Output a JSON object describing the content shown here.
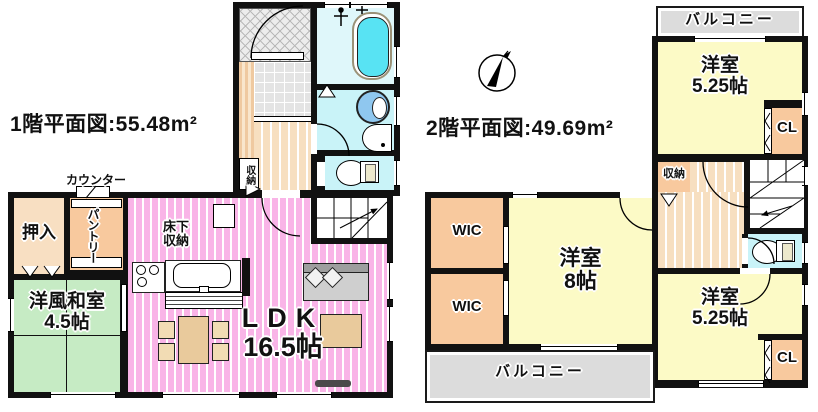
{
  "floor1": {
    "title": "1階平面図:55.48m²",
    "counter_label": "カウンター",
    "pantry": "パントリー",
    "oshiire": "押入",
    "underfloor": [
      "床下",
      "収納"
    ],
    "washitsu": [
      "洋風和室",
      "4.5帖"
    ],
    "ldk": [
      "LDK",
      "16.5帖"
    ],
    "storage": "収納"
  },
  "floor2": {
    "title": "2階平面図:49.69m²",
    "balcony_top": "バルコニー",
    "balcony_bottom": "バルコニー",
    "bedroom_525_top": [
      "洋室",
      "5.25帖"
    ],
    "bedroom_8": [
      "洋室",
      "8帖"
    ],
    "bedroom_525_bottom": [
      "洋室",
      "5.25帖"
    ],
    "wic_top": "WIC",
    "wic_bottom": "WIC",
    "cl_top": "CL",
    "cl_bottom": "CL",
    "storage": "収納"
  },
  "colors": {
    "wall": "#111111",
    "ldk_pink": "#F9B4E7",
    "tatami_green": "#C6EBC4",
    "bedroom_yellow": "#FCFAC6",
    "closet_orange": "#F8C99E",
    "closet_beige": "#F8DFC2",
    "flooring_beige": "#F7DFC0",
    "bath_cyan": "#58E3F3",
    "sanitary_cyan": "#C9F3F8",
    "balcony_gray": "#DCDCDC"
  }
}
